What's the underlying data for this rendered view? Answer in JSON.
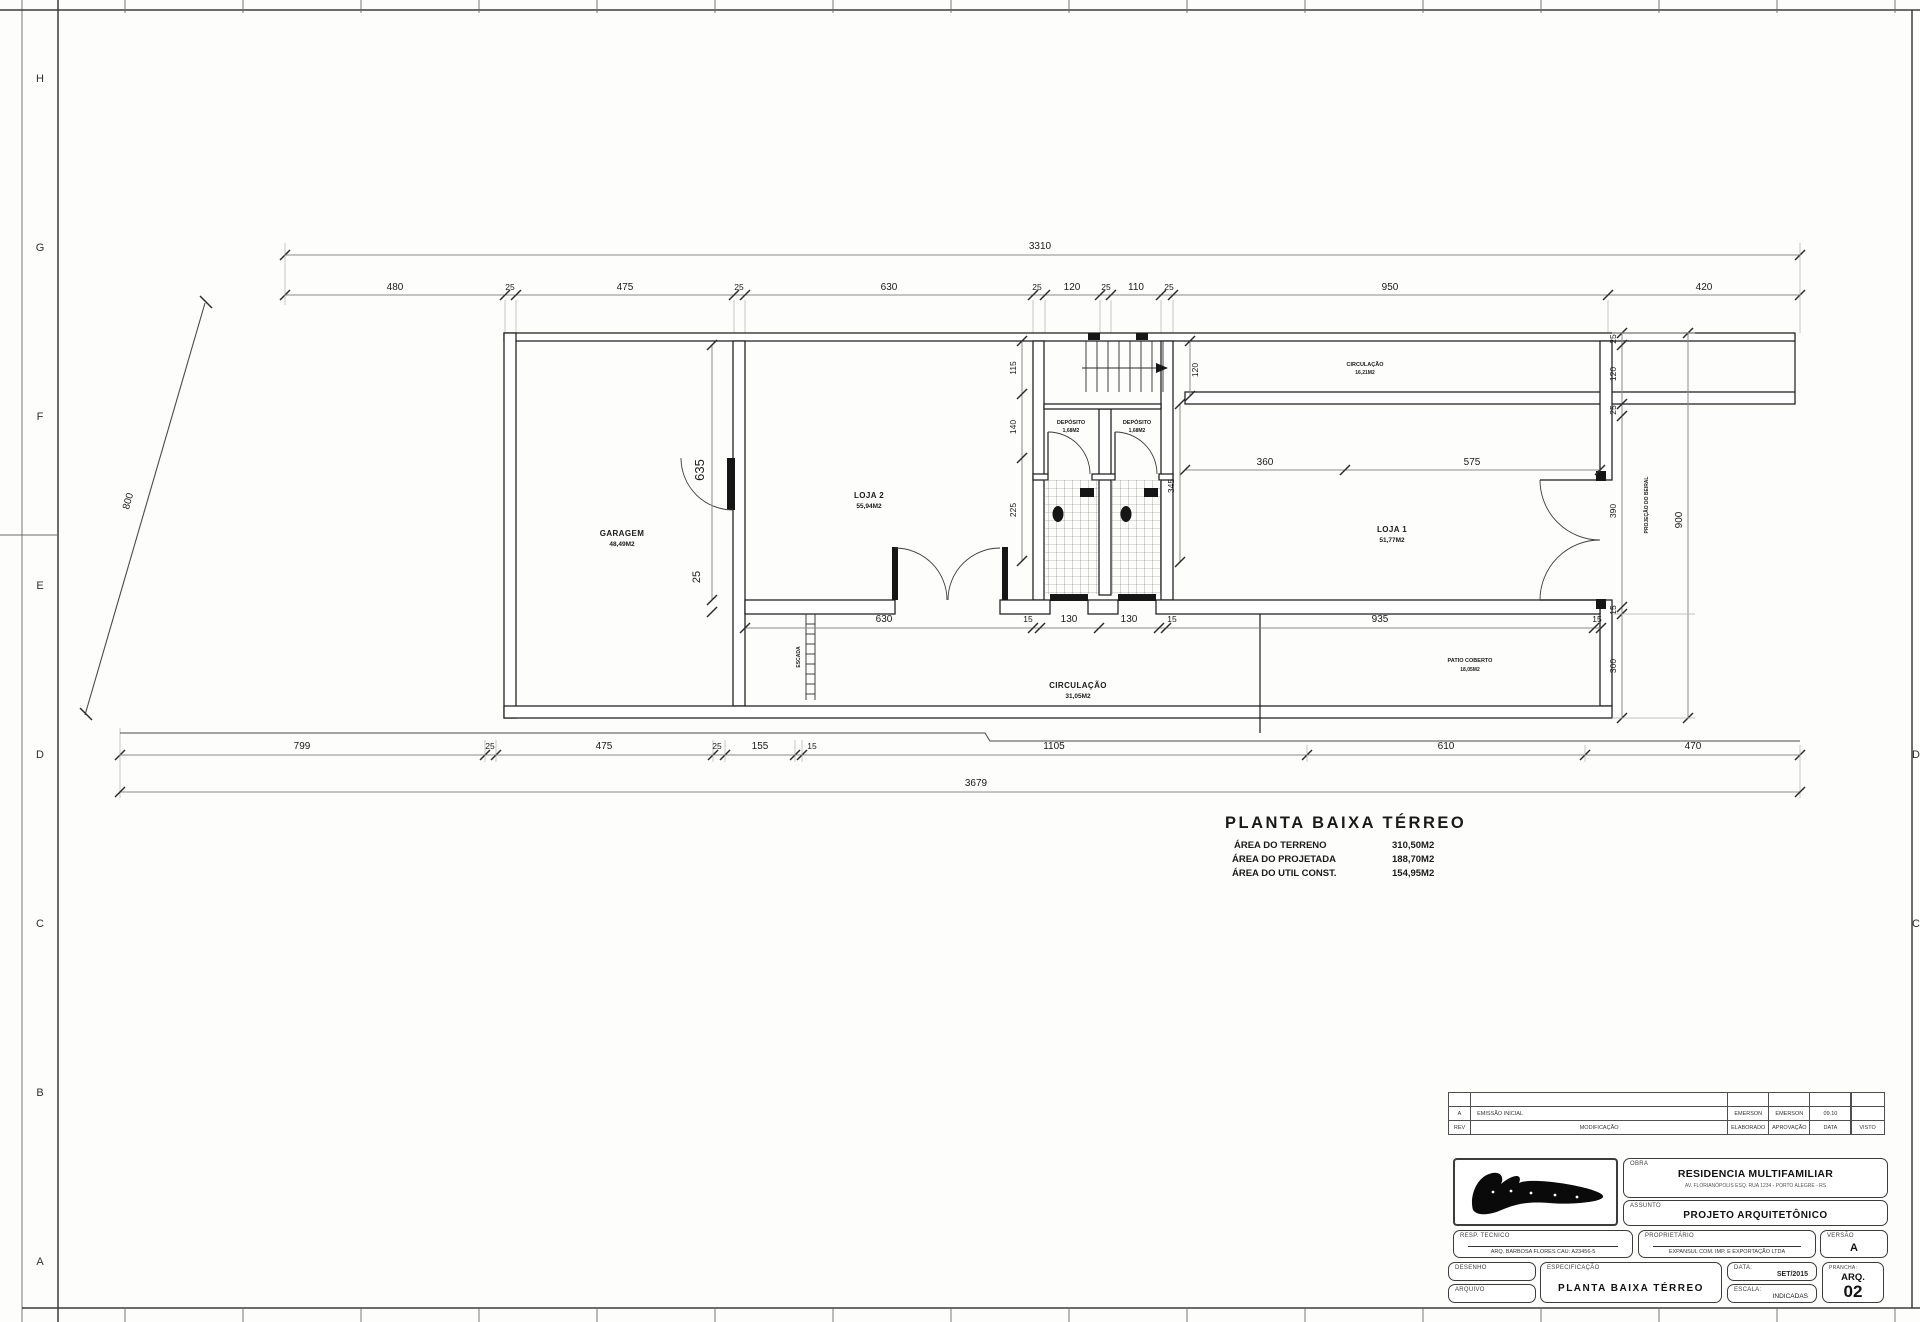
{
  "sheet": {
    "letters_left": [
      "H",
      "G",
      "F",
      "E",
      "D",
      "C",
      "B",
      "A"
    ],
    "letters_right": [
      "D",
      "C"
    ]
  },
  "plan_title": {
    "heading": "PLANTA BAIXA TÉRREO",
    "area_rows": [
      {
        "label": "ÁREA DO TERRENO",
        "value": "310,50M2"
      },
      {
        "label": "ÁREA DO PROJETADA",
        "value": "188,70M2"
      },
      {
        "label": "ÁREA DO UTIL CONST.",
        "value": "154,95M2"
      }
    ]
  },
  "dims": {
    "top_total": "3310",
    "top": [
      "480",
      "25",
      "475",
      "25",
      "630",
      "25",
      "120",
      "25",
      "110",
      "25",
      "950",
      "420"
    ],
    "bottom": [
      "799",
      "25",
      "475",
      "25",
      "155",
      "15",
      "1105",
      "610",
      "470"
    ],
    "bottom_total": "3679",
    "inner": [
      "630",
      "15",
      "130",
      "130",
      "15",
      "935",
      "15"
    ],
    "right_chain": [
      "25",
      "120",
      "25",
      "390",
      "15"
    ],
    "right_total": "900",
    "right_lower": "300",
    "slant": "800",
    "garage_depth": "635",
    "garage_gap": "25",
    "core_left": [
      "115",
      "140",
      "225"
    ],
    "stair_width": "120",
    "loja1_w1": "360",
    "loja1_w2": "575",
    "loja1_depth": "345"
  },
  "rooms": {
    "garagem": {
      "name": "GARAGEM",
      "area": "48,49M2"
    },
    "loja2": {
      "name": "LOJA 2",
      "area": "55,94M2"
    },
    "loja1": {
      "name": "LOJA 1",
      "area": "51,77M2"
    },
    "circulacao_top": {
      "name": "CIRCULAÇÃO",
      "area": "16,21M2"
    },
    "circulacao_bottom": {
      "name": "CIRCULAÇÃO",
      "area": "31,05M2"
    },
    "patio": {
      "name": "PATIO COBERTO",
      "area": "18,05M2"
    },
    "deposito1": {
      "name": "DEPÓSITO",
      "area": "1,68M2"
    },
    "deposito2": {
      "name": "DEPÓSITO",
      "area": "1,68M2"
    },
    "escada": "ESCADA",
    "projecao": "PROJEÇÃO DO BEIRAL"
  },
  "titleblock": {
    "revision": {
      "rows": [
        {
          "rev": "A",
          "desc": "EMISSÃO INICIAL",
          "c1": "EMERSON",
          "c2": "EMERSON",
          "c3": "09.10",
          "c4": ""
        },
        {
          "rev": "REV",
          "desc": "MODIFICAÇÃO",
          "c1": "ELABORADO",
          "c2": "APROVAÇÃO",
          "c3": "DATA",
          "c4": "VISTO"
        }
      ]
    },
    "obra": {
      "label": "OBRA",
      "title": "RESIDENCIA MULTIFAMILIAR",
      "subtitle": "AV. FLORIANÓPOLIS ESQ. RUA 1234 - PORTO ALEGRE - RS"
    },
    "assunto": {
      "label": "ASSUNTO",
      "value": "PROJETO ARQUITETÔNICO"
    },
    "resp": {
      "label": "RESP. TECNICO",
      "value": "ARQ. BARBOSA FLORES   CAU: A23456-5"
    },
    "prop": {
      "label": "PROPRIETÁRIO",
      "value": "EXPANSUL COM. IMP. E EXPORTAÇÃO LTDA"
    },
    "versao": {
      "label": "VERSÃO",
      "value": "A"
    },
    "desenho": {
      "label": "DESENHO"
    },
    "arquivo": {
      "label": "ARQUIVO"
    },
    "espec": {
      "label": "ESPECIFICAÇÃO",
      "value": "PLANTA BAIXA TÉRREO"
    },
    "data": {
      "label": "DATA:",
      "value": "SET/2015"
    },
    "escala": {
      "label": "ESCALA:",
      "value": "INDICADAS"
    },
    "prancha": {
      "label": "PRANCHA:",
      "value": "ARQ.",
      "number": "02"
    }
  }
}
